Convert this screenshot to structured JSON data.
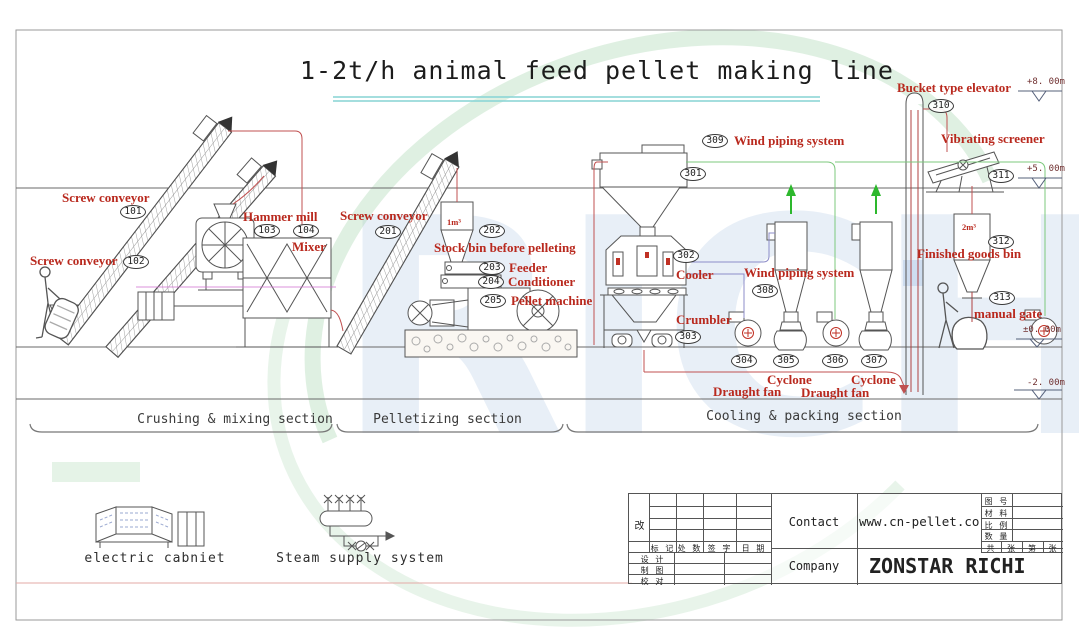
{
  "title": "1-2t/h animal feed pellet making line",
  "watermark_text": "RICHI",
  "colors": {
    "label_red": "#b9291e",
    "pipe_red": "#c05050",
    "pipe_green": "#7cc87c",
    "pipe_blue": "#8c8cc8",
    "arrow_green": "#2db82d",
    "underline_cyan": "#85d4d4"
  },
  "equipment": {
    "screw_conveyor_101": {
      "label": "Screw conveyor",
      "badge": "101"
    },
    "screw_conveyor_102": {
      "label": "Screw conveyor",
      "badge": "102"
    },
    "hammer_mill": {
      "label": "Hammer mill",
      "badge": "103"
    },
    "mixer": {
      "label": "Mixer",
      "badge": "104"
    },
    "screw_conveyor_201": {
      "label": "Screw conveyor",
      "badge": "201"
    },
    "stock_bin": {
      "label": "Stock bin before pelleting",
      "badge": "202",
      "capacity": "1m³"
    },
    "feeder": {
      "label": "Feeder",
      "badge": "203"
    },
    "conditioner": {
      "label": "Conditioner",
      "badge": "204"
    },
    "pellet_machine": {
      "label": "Pellet machine",
      "badge": "205"
    },
    "elevator_hopper": {
      "badge": "301"
    },
    "cooler": {
      "label": "Cooler",
      "badge": "302"
    },
    "crumbler": {
      "label": "Crumbler",
      "badge": "303"
    },
    "draught_fan_1": {
      "label": "Draught fan",
      "badge": "304"
    },
    "cyclone_1": {
      "label": "Cyclone",
      "badge": "305"
    },
    "draught_fan_2": {
      "label": "Draught fan",
      "badge": "306"
    },
    "cyclone_2": {
      "label": "Cyclone",
      "badge": "307"
    },
    "wind_piping_308": {
      "label": "Wind piping system",
      "badge": "308"
    },
    "wind_piping_309": {
      "label": "Wind piping system",
      "badge": "309"
    },
    "bucket_elevator": {
      "label": "Bucket type elevator",
      "badge": "310"
    },
    "vibrating_screener": {
      "label": "Vibrating screener",
      "badge": "311"
    },
    "finished_goods_bin": {
      "label": "Finished goods bin",
      "badge": "312",
      "capacity": "2m³"
    },
    "manual_gate": {
      "label": "manual gate",
      "badge": "313"
    }
  },
  "elevations": {
    "e8": "+8. 00m",
    "e5": "+5. 00m",
    "e0": "±0. 00m",
    "em2": "-2. 00m"
  },
  "sections": {
    "crushing": "Crushing & mixing section",
    "pelletizing": "Pelletizing section",
    "cooling": "Cooling & packing section"
  },
  "legend": {
    "electric_cabinet": "electric cabniet",
    "steam_system": "Steam supply system"
  },
  "title_block": {
    "revision_mark": "改",
    "header_cols": [
      "标 记",
      "处 数",
      "签 字",
      "日 期"
    ],
    "left_rows": [
      "设 计",
      "制 图",
      "校 对"
    ],
    "contact_label": "Contact",
    "contact_value": "www.cn-pellet.com",
    "company_label": "Company",
    "company_value": "ZONSTAR RICHI",
    "spec_rows": [
      "图 号",
      "材 料",
      "比 例",
      "数 量"
    ],
    "sheet_row": [
      "共",
      "张",
      "第",
      "张"
    ]
  }
}
